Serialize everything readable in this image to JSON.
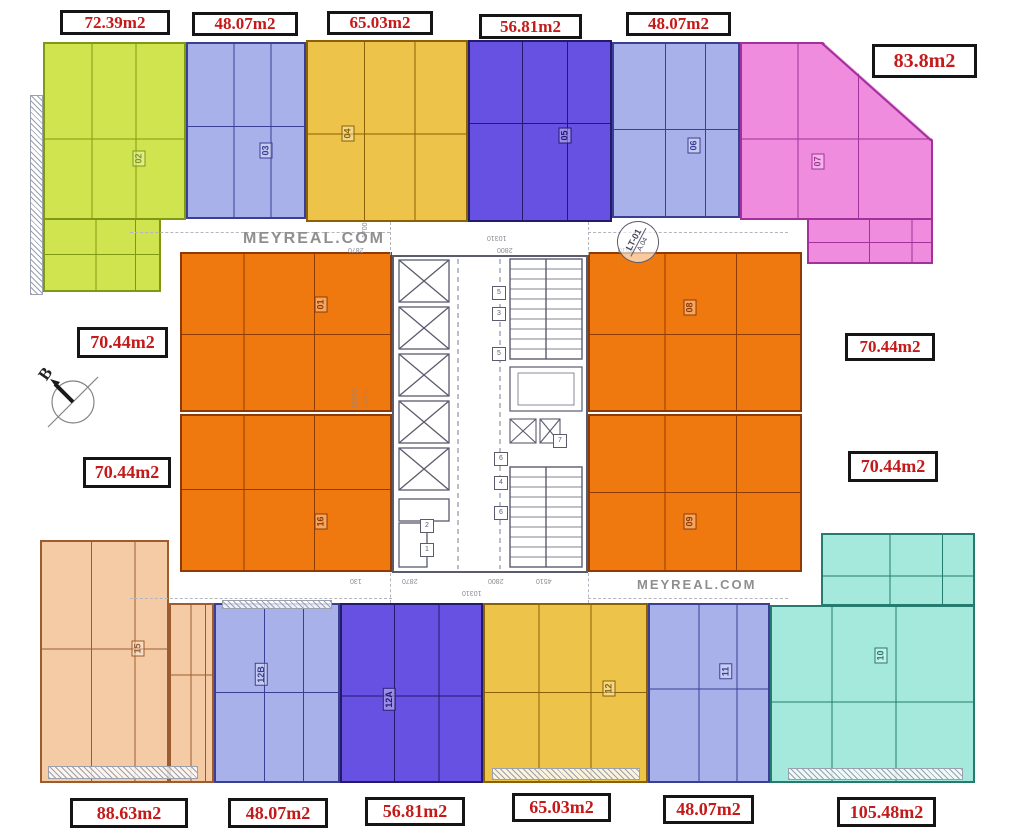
{
  "watermark": {
    "text": "MEYREAL.COM",
    "color": "#8f8f8f"
  },
  "compass": {
    "letter": "B"
  },
  "core": {
    "color": "#5b5b6e",
    "lift_badge_line1": "LT-01",
    "lift_badge_line2": "A.04",
    "shaft_labels": [
      "5",
      "3",
      "5",
      "7",
      "6",
      "4",
      "6",
      "2",
      "1"
    ]
  },
  "dims": {
    "d1700": "1700",
    "d10310": "10310",
    "d2870": "2870",
    "d2800": "2800",
    "d4510": "4510",
    "d130": "130",
    "d15550": "15550",
    "d15500": "15500"
  },
  "apartments": [
    {
      "unit": "02",
      "area": "72.39m2",
      "fill": "#d0e44f",
      "line": "#7f9a12"
    },
    {
      "unit": "03",
      "area": "48.07m2",
      "fill": "#a9b1ea",
      "line": "#3a3f94"
    },
    {
      "unit": "04",
      "area": "65.03m2",
      "fill": "#eec34a",
      "line": "#8a6205"
    },
    {
      "unit": "05",
      "area": "56.81m2",
      "fill": "#6751e3",
      "line": "#231a6e"
    },
    {
      "unit": "06",
      "area": "48.07m2",
      "fill": "#a9b1ea",
      "line": "#3a3f94"
    },
    {
      "unit": "07",
      "area": "83.8m2",
      "fill": "#ef8cdd",
      "line": "#a2319c"
    },
    {
      "unit": "01",
      "area": "70.44m2",
      "fill": "#f0790f",
      "line": "#8f3a00"
    },
    {
      "unit": "16",
      "area": "70.44m2",
      "fill": "#f0790f",
      "line": "#8f3a00"
    },
    {
      "unit": "08",
      "area": "70.44m2",
      "fill": "#f0790f",
      "line": "#8f3a00"
    },
    {
      "unit": "09",
      "area": "70.44m2",
      "fill": "#f0790f",
      "line": "#8f3a00"
    },
    {
      "unit": "15",
      "area": "88.63m2",
      "fill": "#f5cba6",
      "line": "#9c5c30"
    },
    {
      "unit": "12B",
      "area": "48.07m2",
      "fill": "#a9b1ea",
      "line": "#3a3f94"
    },
    {
      "unit": "12A",
      "area": "56.81m2",
      "fill": "#6751e3",
      "line": "#231a6e"
    },
    {
      "unit": "12",
      "area": "65.03m2",
      "fill": "#eec34a",
      "line": "#8a6205"
    },
    {
      "unit": "11",
      "area": "48.07m2",
      "fill": "#a9b1ea",
      "line": "#3a3f94"
    },
    {
      "unit": "10",
      "area": "105.48m2",
      "fill": "#a4e9db",
      "line": "#257c6e"
    }
  ]
}
